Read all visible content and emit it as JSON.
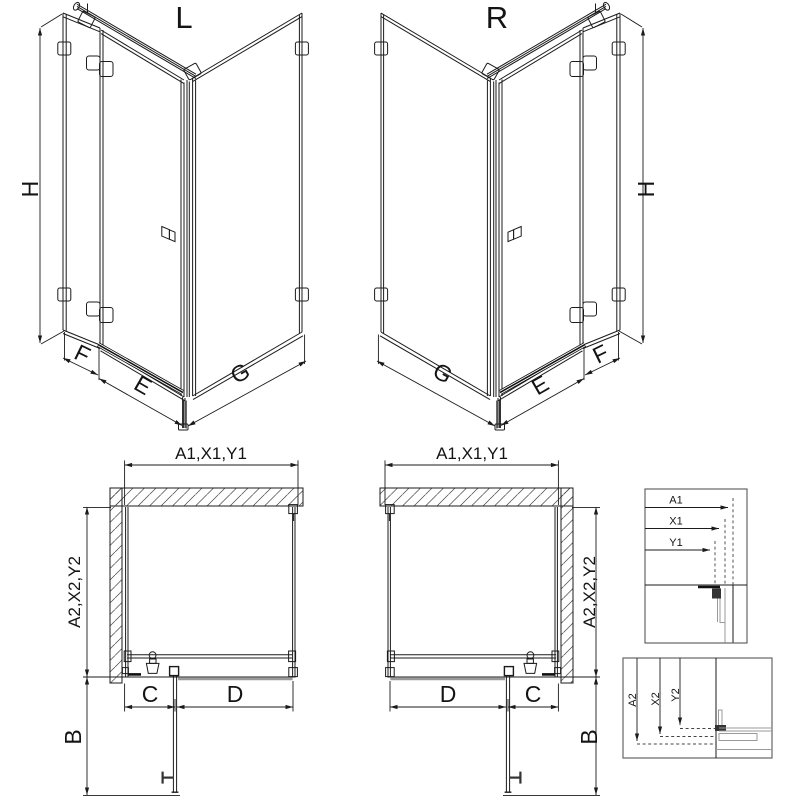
{
  "views": {
    "iso_left": {
      "title": "L",
      "dims": {
        "height": "H",
        "side": "F",
        "front": "E",
        "wall": "G"
      }
    },
    "iso_right": {
      "title": "R",
      "dims": {
        "height": "H",
        "side": "F",
        "front": "E",
        "wall": "G"
      }
    },
    "plan_left": {
      "dims": {
        "width_top": "A1,X1,Y1",
        "depth_side": "A2,X2,Y2",
        "door": "C",
        "panel": "D",
        "swing": "B"
      }
    },
    "plan_right": {
      "dims": {
        "width_top": "A1,X1,Y1",
        "depth_side": "A2,X2,Y2",
        "door": "C",
        "panel": "D",
        "swing": "B"
      }
    },
    "detail_width": {
      "dims": {
        "a1": "A1",
        "x1": "X1",
        "y1": "Y1"
      }
    },
    "detail_depth": {
      "dims": {
        "a2": "A2",
        "x2": "X2",
        "y2": "Y2"
      }
    }
  },
  "colors": {
    "line": "#1b1b1b",
    "glass_gray": "#9a9a9a",
    "background": "#ffffff"
  }
}
